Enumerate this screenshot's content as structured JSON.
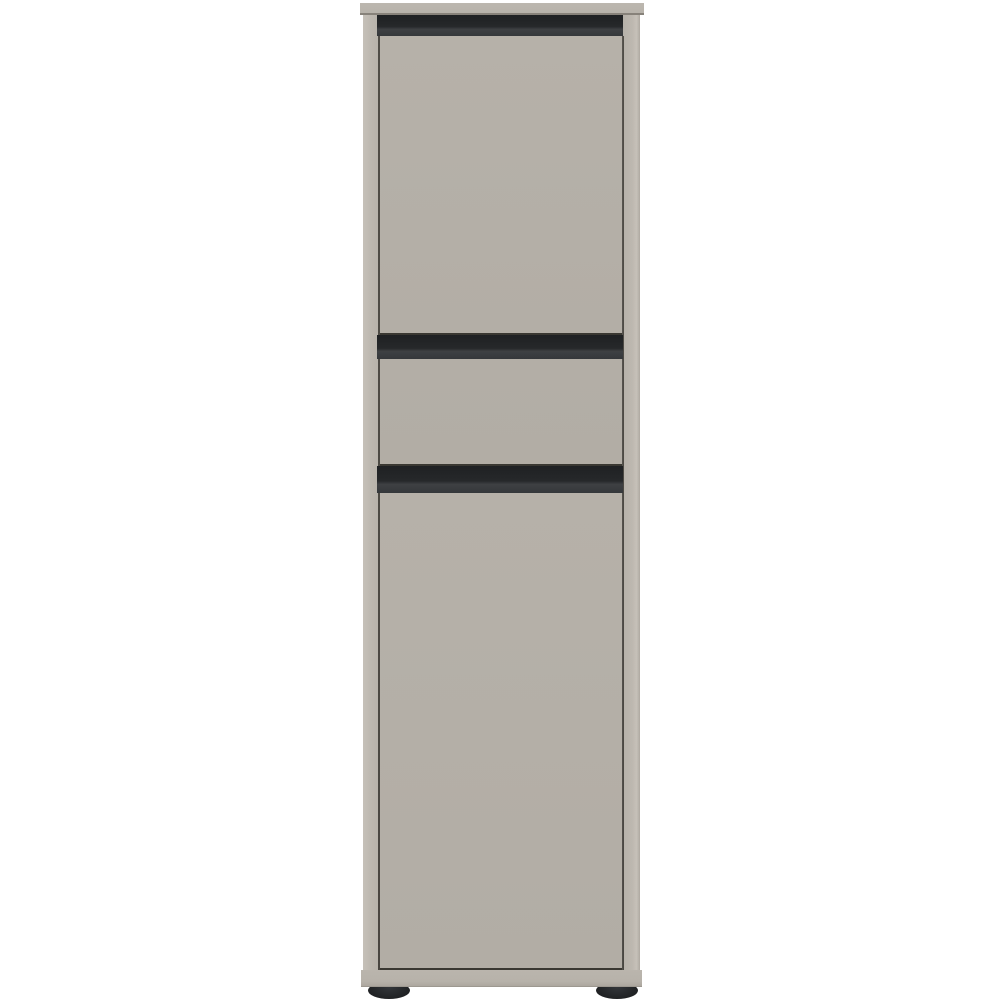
{
  "scene": {
    "alt": "Product photo of a tall narrow greige cabinet with an upper door, a middle drawer and a lower door, separated by black recessed grip strips, standing on two small round black feet against a white background"
  },
  "colors": {
    "background": "#ffffff",
    "panel_top": "#b8b3ab",
    "panel_side": "#bdb8b0",
    "door": "#b3aea6",
    "drawer": "#b2ada5",
    "recess_dark": "#26282a",
    "recess_lip": "#3e4043",
    "gap_line": "#45423c",
    "door_dark_edge": "#3a3832",
    "plinth": "#b7b2aa",
    "foot": "#202224"
  },
  "furniture": {
    "type": "cabinet",
    "parts": [
      "top-panel",
      "left-side-panel",
      "right-side-panel",
      "top-handle-recess",
      "upper-door",
      "middle-handle-recess",
      "drawer-front",
      "lower-handle-recess",
      "lower-door",
      "base-plinth",
      "left-foot",
      "right-foot"
    ]
  }
}
